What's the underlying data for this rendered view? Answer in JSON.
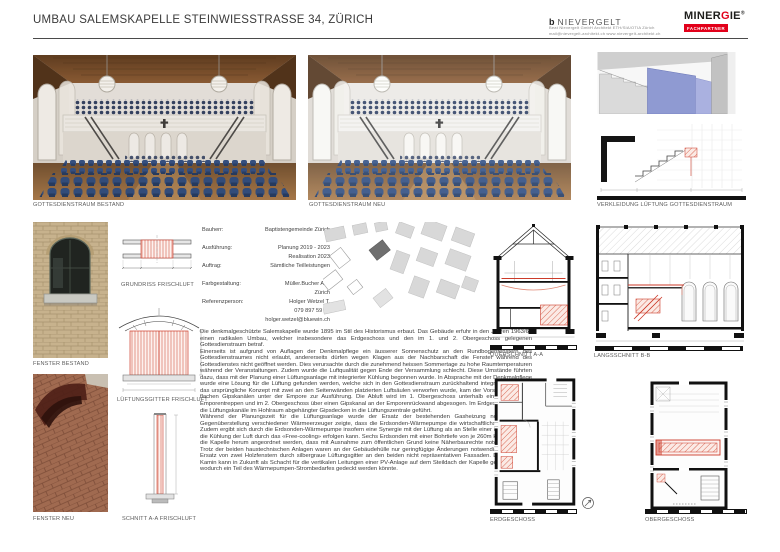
{
  "header": {
    "title": "UMBAU SALEMSKAPELLE STEINWIESSTRASSE 34, ZÜRICH",
    "nievergelt": {
      "mark": "b",
      "name": "NIEVERGELT",
      "line1": "Beat Nievergelt GmbH    Architekt  ETH/SIA/OTIA  Zürich",
      "line2": "mail@nievergelt-architekt.ch    www.nievergelt-architekt.ch"
    },
    "minergie": {
      "brand_left": "MINER",
      "brand_g": "G",
      "brand_right": "IE",
      "registered": "®",
      "badge": "FACHPARTNER"
    }
  },
  "captions": {
    "photo_bestand": "GOTTESDIENSTRAUM BESTAND",
    "photo_neu": "GOTTESDIENSTRAUM NEU",
    "render": "VERKLEIDUNG LÜFTUNG GOTTESDIENSTRAUM",
    "fenster_bestand": "FENSTER BESTAND",
    "fenster_neu": "FENSTER NEU",
    "grundriss": "GRUNDRISS FRISCHLUFT",
    "gitter": "LÜFTUNGSGITTER FRISCHLUFT",
    "schnitt": "SCHNITT A-A FRISCHLUFT",
    "querschnitt": "QUERSCHNITT A-A",
    "langsschnitt": "LANGSSCHNITT B-B",
    "erdgeschoss": "ERDGESCHOSS",
    "obergeschoss": "OBERGESCHOSS"
  },
  "project_info": {
    "rows": [
      {
        "label": "Bauherr:",
        "value": "Baptistengemeinde Zürich"
      },
      {
        "label": "Ausführung:",
        "value": "Planung 2019 - 2023"
      },
      {
        "label": "",
        "value": "Realisation 2023"
      },
      {
        "label": "Auftrag:",
        "value": "Sämtliche Teilleistungen"
      },
      {
        "label": "Farbgestaltung:",
        "value": "Müller.Bucher AG,"
      },
      {
        "label": "",
        "value": "Zürich"
      },
      {
        "label": "Referenzperson:",
        "value": "Holger Wetzel T."
      },
      {
        "label": "",
        "value": "079 897 59 89"
      },
      {
        "label": "",
        "value": "holger.wetzel@bluewin.ch"
      }
    ]
  },
  "body_text": {
    "paragraphs": [
      "Die denkmalgeschützte Salemskapelle wurde 1895 im Stil des Historismus erbaut. Das Gebäude erfuhr in den Jahren 1963/64 einen radikalen Umbau, welcher insbesondere das Erdgeschoss und den im 1. und 2. Obergeschoss gelegenen Gottesdienstraum betraf.",
      "Einerseits ist aufgrund von Auflagen der Denkmalpflege ein äusserer Sonnenschutz an den Rundbogenfenstern des Gottesdienstraumes nicht erlaubt, andererseits dürfen wegen Klagen aus der Nachbarschaft die Fenster während des Gottesdienstes nicht geöffnet werden. Dies verursachte durch die zunehmend heissen Sommertage zu hohe Raumtemperaturen während der Veranstaltungen. Zudem wurde die Luftqualität gegen Ende der Versammlung schlecht. Diese Umstände führten dazu, dass mit der Planung einer Lüftungsanlage mit integrierter Kühlung begonnen wurde. In Absprache mit der Denkmalpflege wurde eine Lösung für die Lüftung gefunden werden, welche sich in den Gottesdienstraum zurückhaltend integriert. Nachdem das ursprüngliche Konzept mit zwei an den Seitenwänden platzierten Luftsäulen verworfen wurde, kam der Vorschlag mit sehr flachen Gipskanälen unter der Empore zur Ausführung. Die Abluft wird im 1. Obergeschoss unterhalb einer der beiden Emporentreppen und im 2. Obergeschoss über einen Gipskanal an der Emporenrückwand abgesogen. Im Erdgeschoss werden die Lüftungskanäle im Hohlraum abgehängter Gipsdecken in die Lüftungszentrale geführt.",
      "Während der Planungszeit für die Lüftungsanlage wurde der Ersatz der bestehenden Gasheizung notwendig. Die Gegenüberstellung verschiedener Wärmeerzeuger zeigte, dass die Erdsonden-Wärmepumpe die wirtschaftlichste Lösung ist. Zudem ergibt sich durch die Erdsonden-Wärmepumpe insofern eine Synergie mit der Lüftung als an Stelle einer Kältemaschine die Kühlung der Luft durch das «Free-cooling» erfolgen kann. Sechs Erdsonden mit einer Bohrtiefe von je 260m konnten so um die Kapelle herum angeordnet werden, dass mit Ausnahme zum öffentlichen Grund keine Näherbaurechte notwendig waren. Trotz der beiden haustechnischen Anlagen waren an der Gebäudehülle nur geringfügige Änderungen notwendig, nämlich der Ersatz von zwei Holzfenstern durch silbergraue Lüftungsgitter an den beiden nicht repräsentativen Fassaden. Der ehemalige Kamin kann in Zukunft als Schacht für die vertikalen Leitungen einer PV-Anlage auf dem Steildach der Kapelle genutzt werden, wodurch ein Teil des Wärmepumpen-Strombedarfes gedeckt werden könnte."
    ]
  },
  "colors": {
    "accent_red": "#cc3b2a",
    "minergie_red": "#e2001a",
    "chair_blue": "#2f4f86",
    "render_blue": "#8f9ad2"
  }
}
